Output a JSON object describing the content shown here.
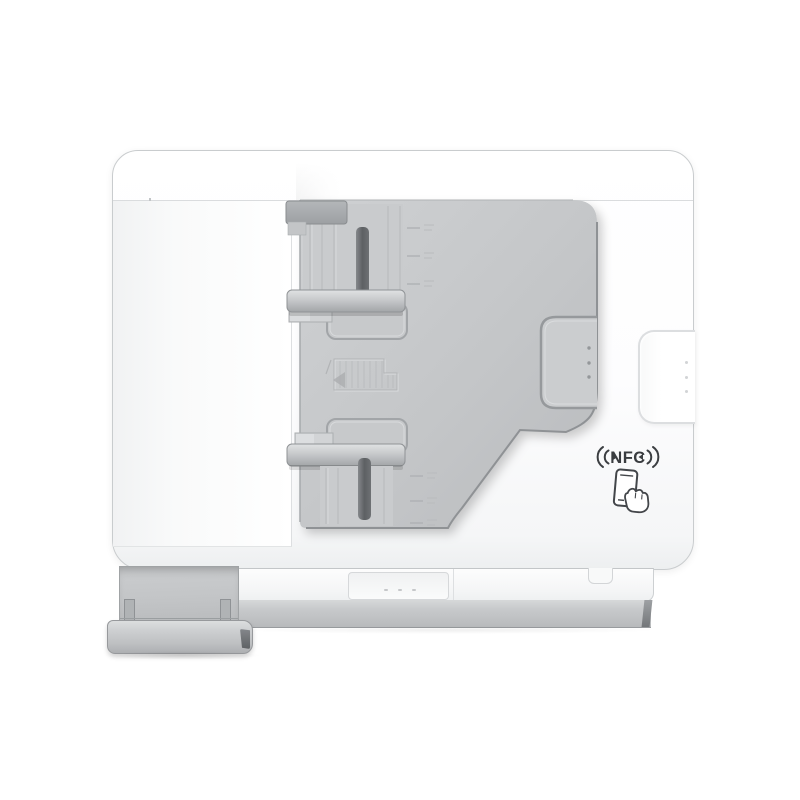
{
  "image": {
    "type": "product-photo",
    "subject": "White multifunction printer seen from above with automatic document feeder tray",
    "background_color": "#ffffff"
  },
  "printer": {
    "nfc_label": "NFC",
    "icons": {
      "nfc_waves": "nfc-contactless-waves-icon",
      "phone_tap": "phone-tap-icon",
      "feed_direction": "document-feed-direction-icon"
    },
    "colors": {
      "body_white": "#fbfcfd",
      "tray_gray": "#c3c5c7",
      "guide_slot_dark": "#5d6063",
      "base_gray": "#bfc1c3",
      "nfc_text": "#3a3d40"
    },
    "details": {
      "tray_handle_dots": 3,
      "side_handle_dots": 3,
      "front_panel_dots": 3,
      "upper_ruler_ticks": 3,
      "lower_ruler_ticks": 3
    }
  }
}
